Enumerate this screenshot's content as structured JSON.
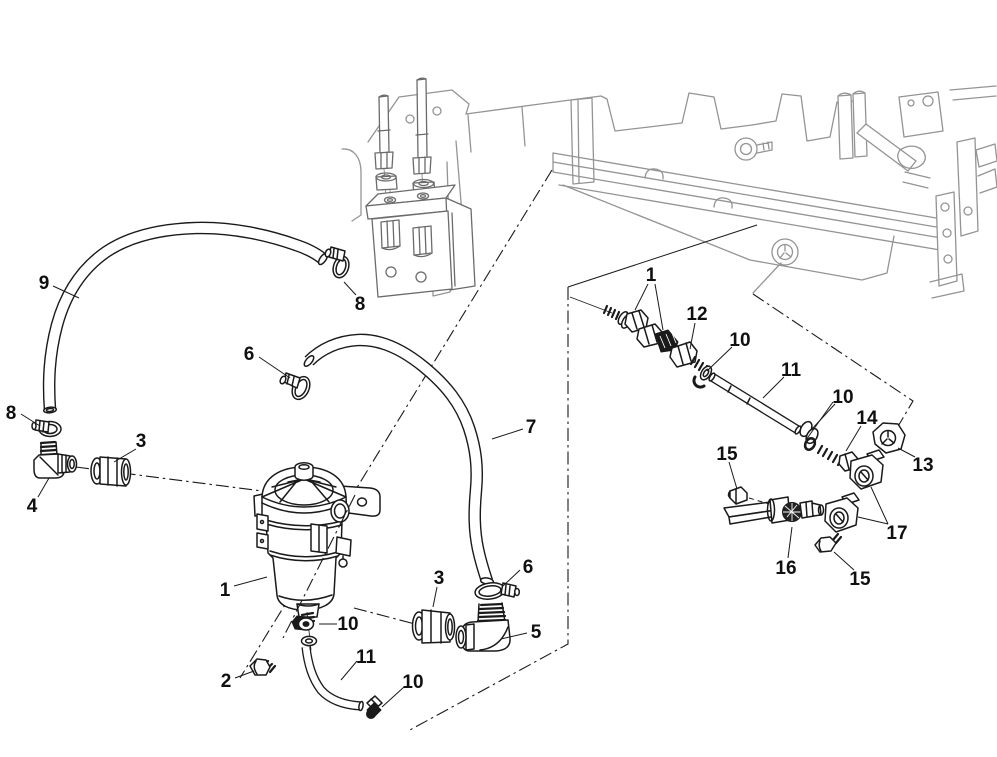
{
  "figure": {
    "kind": "exploded-parts-diagram",
    "subject": "fuel filter / water separator assembly with hoses and fittings on engine",
    "background_color": "#ffffff",
    "part_line_color": "#1a1a1a",
    "context_line_color": "#949494",
    "width": 997,
    "height": 757
  },
  "callouts": [
    {
      "id": "9",
      "label": "9",
      "x": 44,
      "y": 282,
      "leaders": [
        [
          [
            53,
            286
          ],
          [
            79,
            298
          ]
        ]
      ]
    },
    {
      "id": "8a",
      "label": "8",
      "x": 360,
      "y": 303,
      "leaders": [
        [
          [
            356,
            295
          ],
          [
            344,
            282
          ]
        ]
      ]
    },
    {
      "id": "6a",
      "label": "6",
      "x": 249,
      "y": 353,
      "leaders": [
        [
          [
            259,
            357
          ],
          [
            290,
            378
          ]
        ]
      ]
    },
    {
      "id": "7",
      "label": "7",
      "x": 531,
      "y": 426,
      "leaders": [
        [
          [
            523,
            429
          ],
          [
            492,
            439
          ]
        ]
      ]
    },
    {
      "id": "8b",
      "label": "8",
      "x": 11,
      "y": 412,
      "leaders": [
        [
          [
            21,
            414
          ],
          [
            40,
            426
          ]
        ]
      ]
    },
    {
      "id": "3a",
      "label": "3",
      "x": 141,
      "y": 440,
      "leaders": [
        [
          [
            136,
            449
          ],
          [
            114,
            462
          ]
        ]
      ]
    },
    {
      "id": "4",
      "label": "4",
      "x": 32,
      "y": 505,
      "leaders": [
        [
          [
            38,
            497
          ],
          [
            49,
            478
          ]
        ]
      ]
    },
    {
      "id": "1a",
      "label": "1",
      "x": 225,
      "y": 589,
      "leaders": [
        [
          [
            234,
            586
          ],
          [
            267,
            577
          ]
        ]
      ]
    },
    {
      "id": "2",
      "label": "2",
      "x": 226,
      "y": 680,
      "leaders": [
        [
          [
            235,
            678
          ],
          [
            254,
            671
          ]
        ]
      ]
    },
    {
      "id": "10a",
      "label": "10",
      "x": 348,
      "y": 623,
      "leaders": [
        [
          [
            337,
            624
          ],
          [
            319,
            624
          ]
        ]
      ]
    },
    {
      "id": "11a",
      "label": "11",
      "x": 366,
      "y": 656,
      "leaders": [
        [
          [
            357,
            661
          ],
          [
            341,
            680
          ]
        ]
      ]
    },
    {
      "id": "10b",
      "label": "10",
      "x": 413,
      "y": 681,
      "leaders": [
        [
          [
            404,
            687
          ],
          [
            382,
            707
          ]
        ]
      ]
    },
    {
      "id": "3b",
      "label": "3",
      "x": 439,
      "y": 577,
      "leaders": [
        [
          [
            437,
            587
          ],
          [
            433,
            607
          ]
        ]
      ]
    },
    {
      "id": "6b",
      "label": "6",
      "x": 528,
      "y": 566,
      "leaders": [
        [
          [
            520,
            570
          ],
          [
            503,
            586
          ]
        ]
      ]
    },
    {
      "id": "5",
      "label": "5",
      "x": 536,
      "y": 631,
      "leaders": [
        [
          [
            527,
            633
          ],
          [
            501,
            639
          ]
        ]
      ]
    },
    {
      "id": "1b",
      "label": "1",
      "x": 651,
      "y": 274,
      "leaders": [
        [
          [
            648,
            284
          ],
          [
            635,
            310
          ]
        ],
        [
          [
            655,
            284
          ],
          [
            663,
            330
          ]
        ]
      ]
    },
    {
      "id": "12",
      "label": "12",
      "x": 697,
      "y": 313,
      "leaders": [
        [
          [
            695,
            323
          ],
          [
            690,
            349
          ]
        ]
      ]
    },
    {
      "id": "10c",
      "label": "10",
      "x": 740,
      "y": 339,
      "leaders": [
        [
          [
            732,
            347
          ],
          [
            707,
            371
          ]
        ]
      ]
    },
    {
      "id": "11b",
      "label": "11",
      "x": 791,
      "y": 369,
      "leaders": [
        [
          [
            784,
            377
          ],
          [
            763,
            398
          ]
        ]
      ]
    },
    {
      "id": "10d",
      "label": "10",
      "x": 843,
      "y": 396,
      "leaders": [
        [
          [
            835,
            404
          ],
          [
            812,
            429
          ]
        ],
        [
          [
            833,
            402
          ],
          [
            806,
            440
          ]
        ]
      ]
    },
    {
      "id": "14",
      "label": "14",
      "x": 867,
      "y": 417,
      "leaders": [
        [
          [
            861,
            426
          ],
          [
            846,
            451
          ]
        ]
      ]
    },
    {
      "id": "13",
      "label": "13",
      "x": 923,
      "y": 464,
      "leaders": [
        [
          [
            915,
            457
          ],
          [
            898,
            448
          ]
        ]
      ]
    },
    {
      "id": "15a",
      "label": "15",
      "x": 727,
      "y": 453,
      "leaders": [
        [
          [
            729,
            462
          ],
          [
            737,
            489
          ]
        ]
      ]
    },
    {
      "id": "17",
      "label": "17",
      "x": 897,
      "y": 532,
      "leaders": [
        [
          [
            888,
            524
          ],
          [
            871,
            487
          ]
        ],
        [
          [
            888,
            524
          ],
          [
            858,
            517
          ]
        ]
      ]
    },
    {
      "id": "16",
      "label": "16",
      "x": 786,
      "y": 567,
      "leaders": [
        [
          [
            788,
            558
          ],
          [
            792,
            527
          ]
        ]
      ]
    },
    {
      "id": "15b",
      "label": "15",
      "x": 860,
      "y": 578,
      "leaders": [
        [
          [
            854,
            570
          ],
          [
            834,
            552
          ]
        ]
      ]
    }
  ]
}
